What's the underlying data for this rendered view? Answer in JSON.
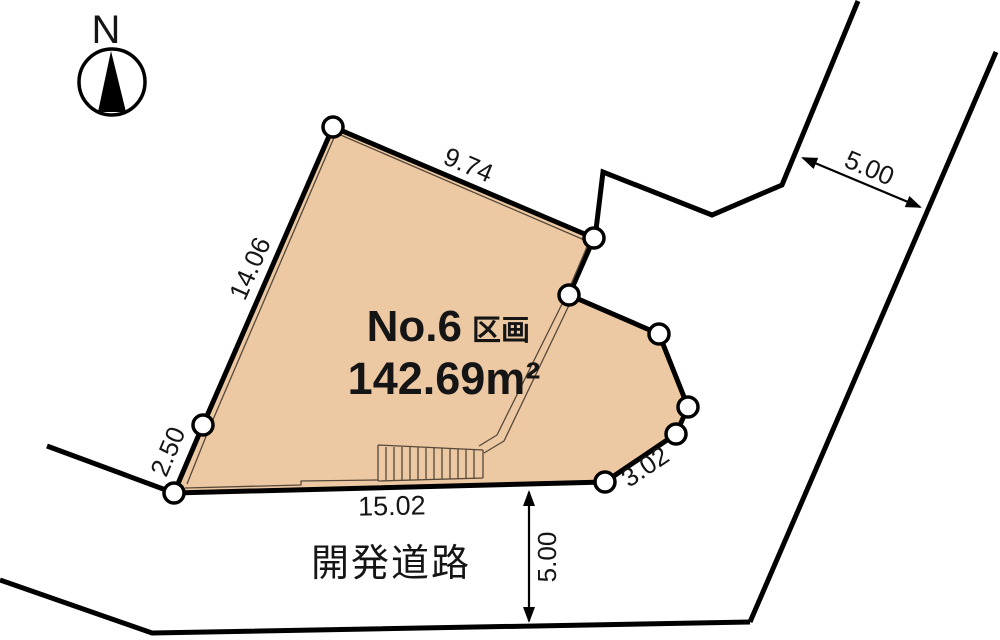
{
  "compass": {
    "label": "N"
  },
  "parcel": {
    "number": "No.6",
    "number_suffix": "区画",
    "area": "142.69m²"
  },
  "dimensions": {
    "top_edge": "9.74",
    "left_edge": "14.06",
    "lower_left_edge": "2.50",
    "bottom_edge": "15.02",
    "lower_right_edge": "3.02",
    "road_width_upper_right": "5.00",
    "road_width_bottom": "5.00"
  },
  "road": {
    "label": "開発道路"
  },
  "colors": {
    "parcel_fill": "#edc9a3",
    "line": "#000000",
    "detail_line": "#55483a"
  }
}
